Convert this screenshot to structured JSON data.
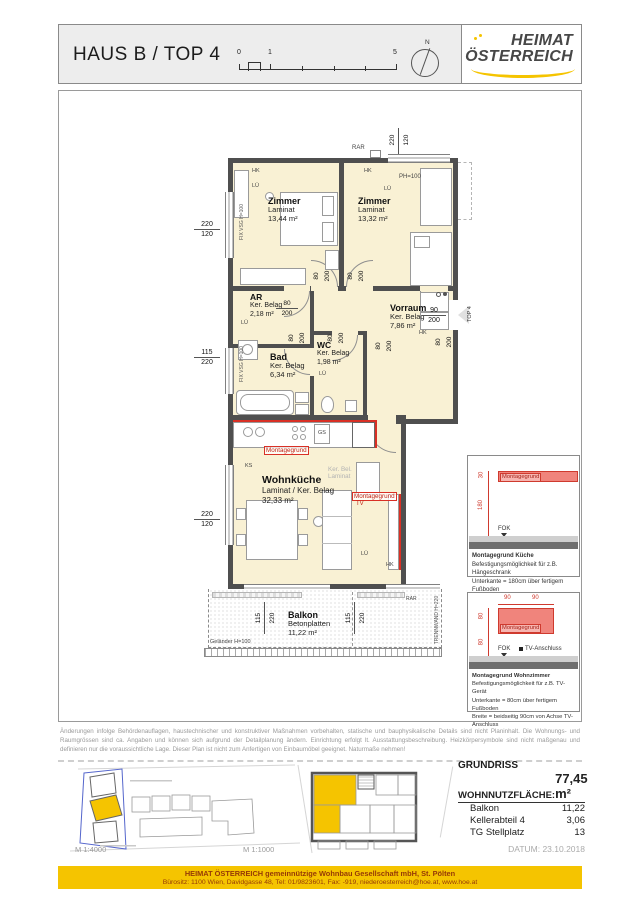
{
  "header": {
    "title": "HAUS B / TOP 4",
    "scale_ticks": {
      "t0": "0",
      "t1": "1",
      "t5": "5"
    },
    "north": "N",
    "logo_line1": "HEIMAT",
    "logo_line2": "ÖSTERREICH"
  },
  "rooms": [
    {
      "name": "Zimmer",
      "floor": "Laminat",
      "area": "13,44 m²"
    },
    {
      "name": "Zimmer",
      "floor": "Laminat",
      "area": "13,32 m²"
    },
    {
      "name": "AR",
      "floor": "Ker. Belag",
      "area": "2,18 m²"
    },
    {
      "name": "Vorraum",
      "floor": "Ker. Belag",
      "area": "7,86 m²"
    },
    {
      "name": "Bad",
      "floor": "Ker. Belag",
      "area": "6,34 m²"
    },
    {
      "name": "WC",
      "floor": "Ker. Belag",
      "area": "1,98 m²"
    },
    {
      "name": "Wohnküche",
      "floor": "Laminat / Ker. Belag",
      "area": "32,33 m²"
    },
    {
      "name": "Balkon",
      "floor": "Betonplatten",
      "area": "11,22 m²"
    }
  ],
  "dims": {
    "window_top": [
      "220",
      "120"
    ],
    "left_upper": [
      "220",
      "120"
    ],
    "left_mid": [
      "115",
      "220"
    ],
    "left_lower": [
      "220",
      "120"
    ],
    "balkon_left": [
      "115",
      "220"
    ],
    "balkon_right": [
      "115",
      "220"
    ],
    "door_ar": [
      "80",
      "200"
    ],
    "door_zimmer1": [
      "80",
      "200"
    ],
    "door_zimmer2": [
      "80",
      "200"
    ],
    "door_vorraum": [
      "80",
      "200"
    ],
    "door_bad": [
      "80",
      "200"
    ],
    "door_wc": [
      "80",
      "200"
    ],
    "door_wk": [
      "80",
      "200"
    ],
    "entrance": [
      "90",
      "200"
    ]
  },
  "annotations": {
    "rar": "RAR",
    "ph100": "PH=100",
    "hk": "HK",
    "lue": "LÜ",
    "ks": "KS",
    "gs": "GS",
    "fix_vsg": "FIX VSG H=100",
    "top_marker": "TOP 4",
    "ker_bel_1": "Ker. Bel.",
    "ker_bel_2": "Laminat",
    "montagegrund": "Montagegrund",
    "tv": "TV",
    "gelaender": "Geländer H=100",
    "trennwand": "TRENNWAND H=220"
  },
  "montage_panels": [
    {
      "bar_label": "Montagegrund",
      "dim_offset": "30",
      "dim_height": "180",
      "fok": "FOK",
      "title": "Montagegrund Küche",
      "line1": "Befestigungsmöglichkeit für z.B. Hängeschrank",
      "line2": "Unterkante = 180cm über fertigem Fußboden",
      "line3": ""
    },
    {
      "bar_label": "Montagegrund",
      "dim_w1": "90",
      "dim_w2": "90",
      "dim_h1": "80",
      "dim_h2": "80",
      "fok": "FOK",
      "tv_label": "TV-Anschluss",
      "title": "Montagegrund Wohnzimmer",
      "line1": "Befestigungsmöglichkeit für z.B. TV-Gerät",
      "line2": "Unterkante = 80cm über fertigem Fußboden",
      "line3": "Breite = beidseitig 90cm von Achse TV-Anschluss"
    }
  ],
  "disclaimer": "Änderungen infolge Behördenauflagen, haustechnischer und konstruktiver Maßnahmen vorbehalten, statische und bauphysikalische Details sind nicht Planinhalt. Die Wohnungs- und Raumgrössen sind ca. Angaben und können sich aufgrund der Detailplanung ändern. Einrichtung erfolgt lt. Ausstattungsbeschreibung. Heizkörpersymbole sind nicht maßgenau und definieren nur die voraussichtliche Lage. Dieser Plan ist nicht zum Anfertigen von Einbaumöbel geeignet. Naturmaße nehmen!",
  "site_plans": {
    "scale_left": "M 1:4000",
    "scale_right": "M 1:1000"
  },
  "summary": {
    "title": "GRUNDRISS",
    "area_label": "WOHNNUTZFLÄCHE:",
    "area_value": "77,45 m²",
    "rows": [
      {
        "label": "Balkon",
        "value": "11,22"
      },
      {
        "label": "Kellerabteil 4",
        "value": "3,06"
      },
      {
        "label": "TG Stellplatz",
        "value": "13"
      }
    ],
    "date": "DATUM: 23.10.2018"
  },
  "footer": {
    "line1": "HEIMAT ÖSTERREICH gemeinnützige Wohnbau Gesellschaft mbH, St. Pölten",
    "line2": "Bürositz: 1100 Wien, Davidgasse 48, Tel: 01/9823601, Fax: -919, niederoesterreich@hoe.at, www.hoe.at"
  },
  "colors": {
    "accent_yellow": "#F5C400",
    "montage_red": "#D93025",
    "room_fill": "#F9F1D4",
    "wall": "#4F4F4F"
  }
}
